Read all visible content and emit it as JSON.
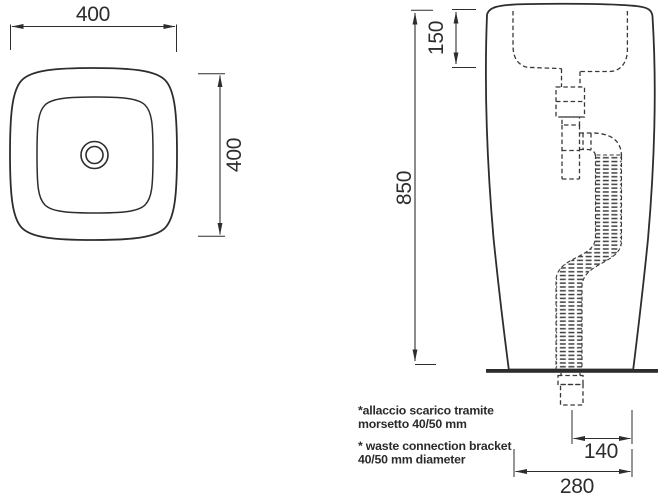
{
  "page": {
    "background": "#ffffff",
    "line_color": "#2d2d2d",
    "drawing_type": "washbasin technical drawing"
  },
  "top_view": {
    "width_dim": "400",
    "height_dim": "400"
  },
  "side_view": {
    "basin_depth_dim": "150",
    "total_height_dim": "850",
    "drain_offset_dim": "140",
    "base_width_dim": "280"
  },
  "notes": {
    "italian_line1": "*allaccio scarico tramite",
    "italian_line2": "morsetto 40/50 mm",
    "english_line1": "* waste connection bracket",
    "english_line2": "40/50 mm diameter"
  }
}
